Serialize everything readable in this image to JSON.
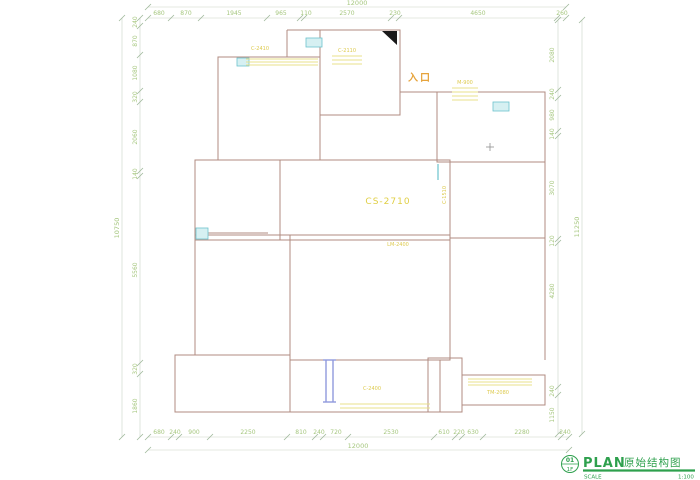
{
  "plan": {
    "labels": {
      "entrance": "入口",
      "center_window": "CS-2710",
      "beam": "LM-2400",
      "top_left_window": "C-2410",
      "top_mid_window": "C-2110",
      "entry_door": "M-900",
      "right_window": "C-1510",
      "bottom_window": "C-2400",
      "balcony_window": "TM-2080"
    },
    "dims": {
      "top": [
        "680",
        "870",
        "1945",
        "965",
        "110",
        "2570",
        "230",
        "4650",
        "260"
      ],
      "top_total": "12000",
      "bottom": [
        "680",
        "240",
        "900",
        "2250",
        "810",
        "240",
        "720",
        "2530",
        "610",
        "220",
        "630",
        "2280",
        "240"
      ],
      "bottom_total": "12000",
      "left": [
        "240",
        "870",
        "1080",
        "320",
        "2060",
        "140",
        "5560",
        "320",
        "1860"
      ],
      "left_total": "10750",
      "right": [
        "2080",
        "240",
        "980",
        "140",
        "3070",
        "120",
        "4280",
        "240",
        "1150"
      ],
      "right_total": "11250"
    },
    "colors": {
      "walls": "#b08b80",
      "dimension_text": "#a6c77f",
      "yellow_annotation": "#ddca4e",
      "entrance_text": "#e6a33b",
      "window_cyan": "#6cc3cd",
      "window_blue": "#909add",
      "titleblock_green": "#2ea04d"
    }
  },
  "titleblock": {
    "number": "01",
    "floor": "1F",
    "title_en": "PLAN",
    "title_cn": "原始结构图",
    "scale_label": "SCALE",
    "scale_value": "1:100"
  }
}
